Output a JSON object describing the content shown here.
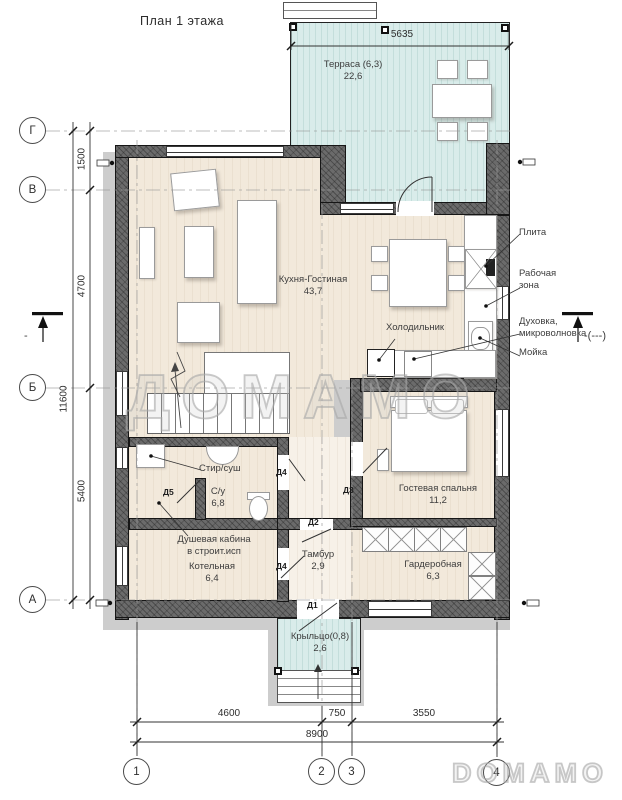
{
  "title": "План 1 этажа",
  "watermarks": {
    "center": "ДОМАМО",
    "corner": "DOMAMO"
  },
  "axes": {
    "rows": [
      {
        "label": "Г"
      },
      {
        "label": "В"
      },
      {
        "label": "Б"
      },
      {
        "label": "А"
      }
    ],
    "cols": [
      {
        "label": "1"
      },
      {
        "label": "2"
      },
      {
        "label": "3"
      },
      {
        "label": "4"
      }
    ]
  },
  "dims": {
    "top_width": "5635",
    "left": {
      "g_v": "1500",
      "v_b": "4700",
      "b_a": "5400",
      "total": "11600"
    },
    "bottom": {
      "s1": "4600",
      "s2": "750",
      "s3": "3550",
      "total": "8900"
    }
  },
  "rooms": {
    "terrace": {
      "name": "Терраса (6,3)",
      "area": "22,6"
    },
    "living": {
      "name": "Кухня-Гостиная",
      "area": "43,7"
    },
    "bathroom": {
      "name": "С/у",
      "area": "6,8"
    },
    "shower": {
      "line1": "Душевая кабина",
      "line2": "в строит.исп"
    },
    "boiler": {
      "name": "Котельная",
      "area": "6,4"
    },
    "vestibule": {
      "name": "Тамбур",
      "area": "2,9"
    },
    "bedroom": {
      "name": "Гостевая спальня",
      "area": "11,2"
    },
    "wardrobe": {
      "name": "Гардеробная",
      "area": "6,3"
    },
    "porch": {
      "name": "Крыльцо(0,8)",
      "area": "2,6"
    }
  },
  "kitchen": {
    "stove": "Плита",
    "work_zone_1": "Рабочая",
    "work_zone_2": "зона",
    "oven_1": "Духовка,",
    "oven_2": "микроволновка",
    "sink": "Мойка",
    "fridge": "Холодильник",
    "washer": "Стир/суш"
  },
  "doors": {
    "d1": "Д1",
    "d2": "Д2",
    "d3": "Д3",
    "d4": "Д4",
    "d5": "Д5"
  },
  "sections": {
    "left": "-",
    "right": "-(---)"
  },
  "colors": {
    "terrace": "#d9ecea",
    "wall": "#6b6b6b",
    "floor": "#f2e9db",
    "shadow": "#cdcdcd"
  }
}
